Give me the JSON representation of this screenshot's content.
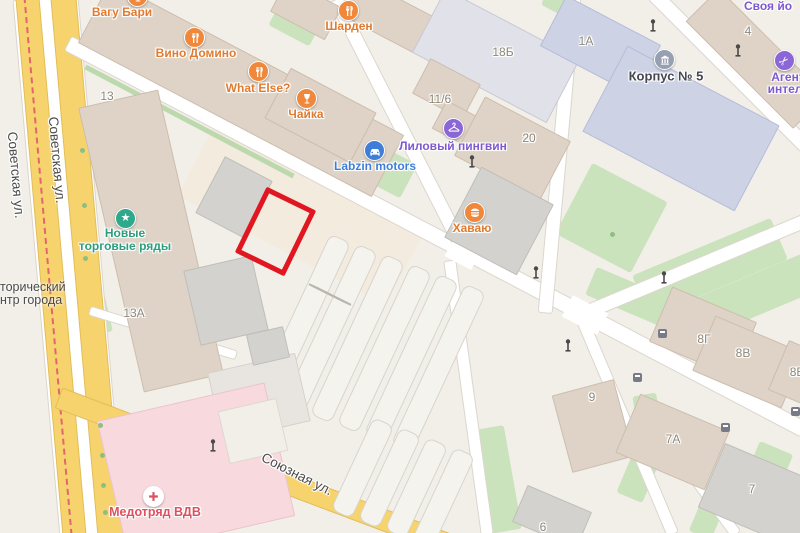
{
  "app": {
    "type": "map-viewport"
  },
  "streets": [
    {
      "name": "Советская ул."
    },
    {
      "name": "Союзная ул."
    }
  ],
  "district": {
    "line1": "торический",
    "line2": "нтр города"
  },
  "numbers": [
    {
      "v": "13"
    },
    {
      "v": "13А"
    },
    {
      "v": "11/6"
    },
    {
      "v": "18Б"
    },
    {
      "v": "20"
    },
    {
      "v": "1А"
    },
    {
      "v": "4"
    },
    {
      "v": "8Г"
    },
    {
      "v": "8В"
    },
    {
      "v": "8Б"
    },
    {
      "v": "9"
    },
    {
      "v": "7А"
    },
    {
      "v": "7"
    },
    {
      "v": "6"
    }
  ],
  "pois": [
    {
      "label": "Вагу Бари",
      "category": "bar"
    },
    {
      "label": "Вино Домино",
      "category": "restaurant"
    },
    {
      "label": "Шарден",
      "category": "restaurant"
    },
    {
      "label": "What Else?",
      "category": "restaurant"
    },
    {
      "label": "Чайка",
      "category": "bar"
    },
    {
      "label": "Labzin motors",
      "category": "car-service"
    },
    {
      "label": "Лиловый пингвин",
      "category": "dry-cleaning"
    },
    {
      "label": "Хаваю",
      "category": "fastfood"
    },
    {
      "label": "Новые торговые ряды",
      "line1": "Новые",
      "line2": "торговые ряды",
      "category": "market"
    },
    {
      "label": "Корпус № 5",
      "category": "organization"
    },
    {
      "label": "Агент интеллиг",
      "line1": "Агент",
      "line2": "интеллиг",
      "category": "beauty"
    },
    {
      "label": "Своя йо",
      "category": "yoga"
    },
    {
      "label": "Медотряд ВДВ",
      "category": "medical"
    }
  ],
  "highlight": {
    "shape": "rotated-rectangle",
    "color": "#e01620"
  },
  "colors": {
    "road_yellow": "#f7d36e",
    "tram_line": "#e2646e",
    "green": "#cbe3bd",
    "building_beige": "#ded3c6",
    "building_lavender": "#cdd2e5",
    "building_pink": "#f7d9de",
    "poi_orange": "#f0883b",
    "poi_blue": "#3e7dd8",
    "poi_purple": "#8a66d6",
    "poi_teal": "#2fa98c",
    "poi_red": "#de5060",
    "highlight_red": "#e01620"
  }
}
